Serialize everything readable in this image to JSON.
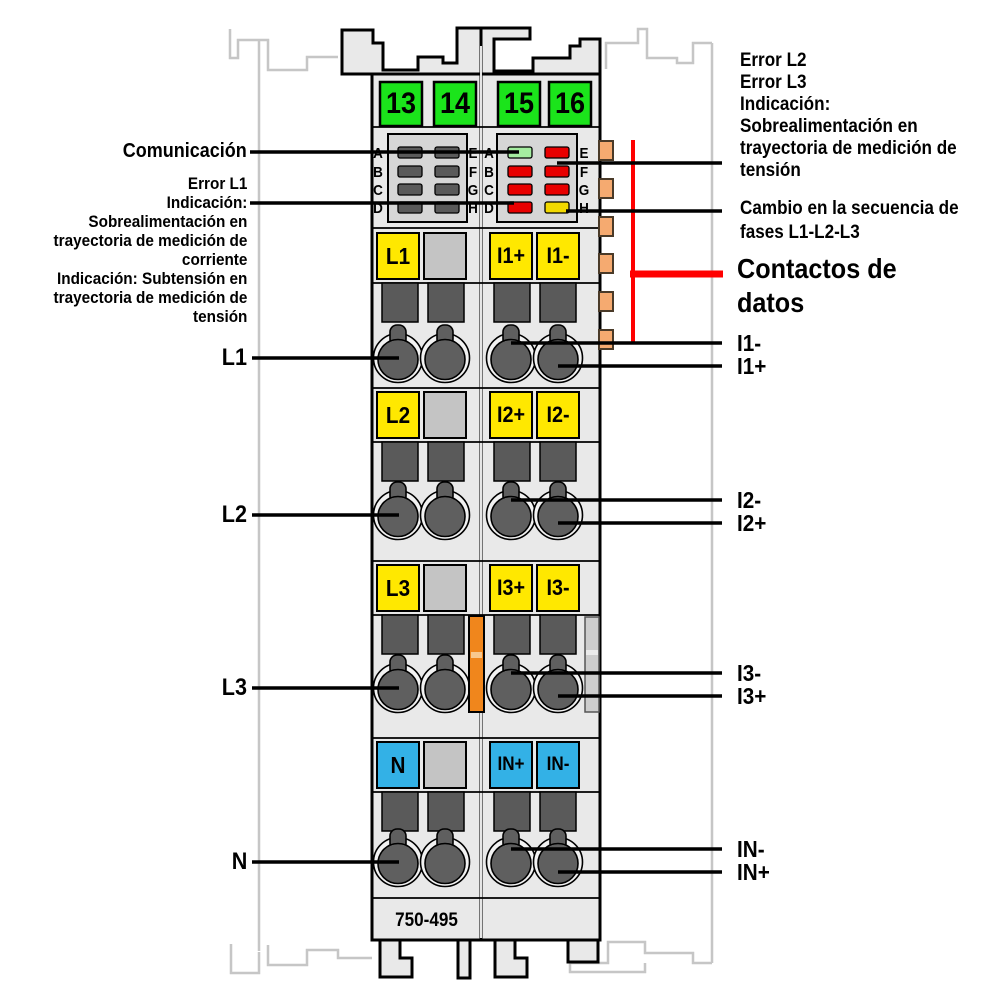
{
  "device": {
    "part_number": "750-495",
    "clamp_numbers": [
      "13",
      "14",
      "15",
      "16"
    ],
    "led_letters_left": [
      "A",
      "B",
      "C",
      "D"
    ],
    "led_letters_right": [
      "E",
      "F",
      "G",
      "H"
    ],
    "phase_terminals": [
      "L1",
      "L2",
      "L3",
      "N"
    ],
    "current_terminals_plus": [
      "I1+",
      "I2+",
      "I3+",
      "IN+"
    ],
    "current_terminals_minus": [
      "I1-",
      "I2-",
      "I3-",
      "IN-"
    ]
  },
  "callouts": {
    "left": {
      "communication": "Comunicación",
      "error_l1": "Error L1\nIndicación:\nSobrealimentación en\ntrayectoria de medición de\ncorriente\nIndicación: Subtensión en\ntrayectoria de medición de\ntensión",
      "phase_labels": [
        "L1",
        "L2",
        "L3",
        "N"
      ]
    },
    "right": {
      "error_l2_l3": "Error L2\nError L3\nIndicación:\nSobrealimentación en\ntrayectoria de medición de\ntensión",
      "phase_sequence": "Cambio en la secuencia de\nfases L1-L2-L3",
      "data_contacts": "Contactos de\ndatos",
      "current_minus": [
        "I1-",
        "I2-",
        "I3-",
        "IN-"
      ],
      "current_plus": [
        "I1+",
        "I2+",
        "I3+",
        "IN+"
      ]
    }
  },
  "colors": {
    "module_body": "#e9e9e9",
    "led_panel": "#d6d6d6",
    "clamp_green": "#1be41b",
    "label_yellow": "#ffe800",
    "label_blue": "#33b1e6",
    "slider_gray": "#c4c4c4",
    "led_off_gray": "#5a5a5a",
    "led_red": "#e80000",
    "led_green": "#a5eda0",
    "led_yellow": "#f2d900",
    "data_contact_orange": "#f5aa70",
    "latch_orange": "#f0861c",
    "callout_red": "#ff0000",
    "ghost_gray": "#c6c6c6"
  }
}
